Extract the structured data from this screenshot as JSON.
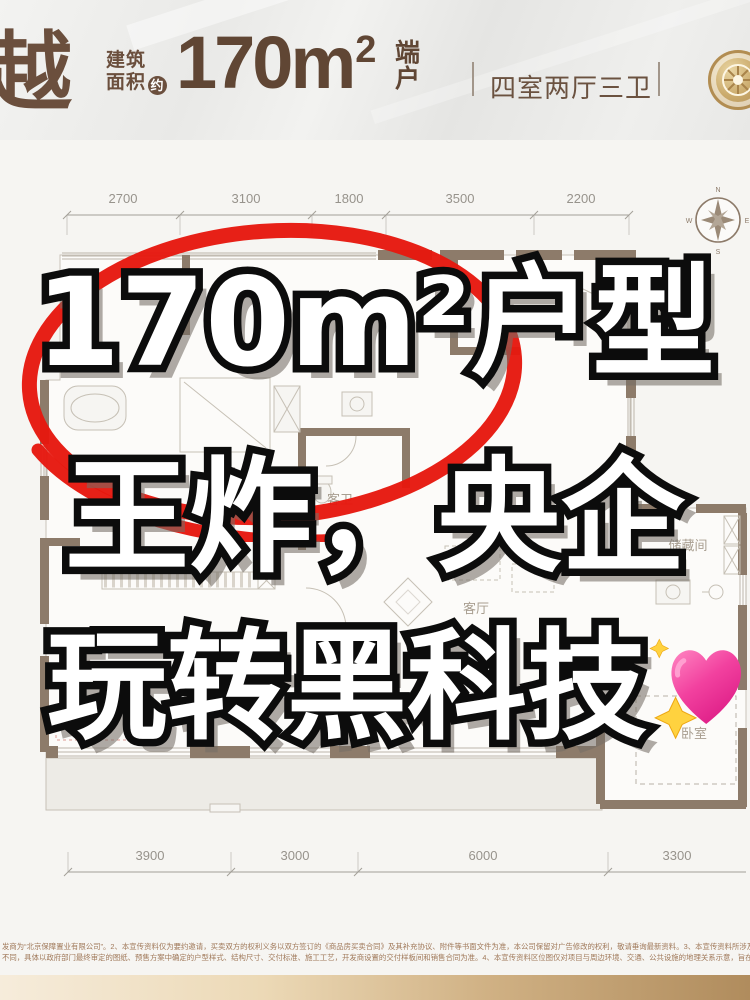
{
  "header": {
    "brand_char": "越",
    "area_label_line1": "建筑",
    "area_label_line2": "面积",
    "approx_badge": "约",
    "area_value": "170m",
    "area_sup": "2",
    "unit_suffix_line1": "端",
    "unit_suffix_line2": "户",
    "layout_text": "四室两厅三卫"
  },
  "overlay": {
    "line1": "170m²户型",
    "line2": "王炸，央企",
    "line3": "玩转黑科技",
    "emoji_name": "sparkling-heart"
  },
  "floorplan": {
    "top_dims": [
      "2700",
      "3100",
      "1800",
      "3500",
      "2200"
    ],
    "bottom_dims": [
      "3900",
      "3000",
      "6000",
      "3300"
    ],
    "rooms": {
      "guest_bath": "客卫",
      "living": "客厅",
      "storage": "储藏间",
      "bedroom": "卧室"
    },
    "compass": {
      "n": "N",
      "e": "E",
      "s": "S",
      "w": "W"
    }
  },
  "disclaimer": {
    "line1": "发商为“北京保障置业有限公司”。2、本宣传资料仅为要约邀请，买卖双方的权利义务以双方签订的《商品房买卖合同》及其补充协议、附件等书面文件为准，本公司保留对广告修改的权利，敬请垂询最新资料。3、本宣传资料所涉及的户型仅供示意参考，不同户型的面积尺寸、功能布局、空间分隔、门窗/管井形态各有",
    "line2": "不同，具体以政府部门最终审定的图纸、预售方案中确定的户型样式、结构尺寸、交付标准、施工工艺，开发商设置的交付样板间和销售合同为准。4、本宣传资料区位图仅对项目与周边环境、交通、公共设施的地理关系示意，旨在协助提供相关信息，不意味着本公司对此作出任何承诺，制作日期：2024年01月。"
  },
  "colors": {
    "brand_brown": "#6b4f3d",
    "wall_taupe": "#8d7b6a",
    "circle_red": "#e6170e",
    "heart_pink": "#f2419f",
    "sparkle_yellow": "#ffd23f",
    "footer_tan": "#b08c5d"
  }
}
